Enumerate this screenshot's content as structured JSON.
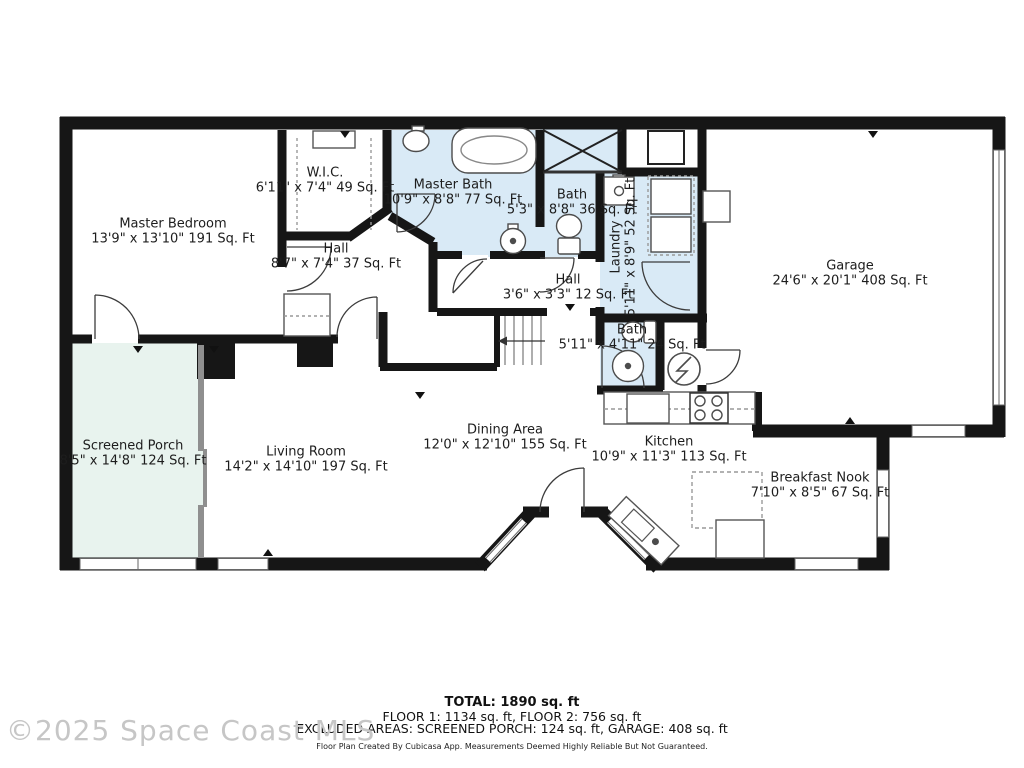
{
  "watermark": "©2025 Space Coast MLS",
  "rooms": {
    "master_bedroom": {
      "name": "Master Bedroom",
      "dims": "13'9\" x 13'10\" 191 Sq. Ft"
    },
    "wic": {
      "name": "W.I.C.",
      "dims": "6'11\" x 7'4\" 49 Sq. Ft"
    },
    "master_bath": {
      "name": "Master Bath",
      "dims": "10'9\" x 8'8\" 77 Sq. Ft"
    },
    "bath_upper": {
      "name": "Bath",
      "dims": "5'3\" x 8'8\" 36 Sq. Ft"
    },
    "laundry": {
      "name": "Laundry",
      "dims": "5'11\" x 8'9\" 52 Sq. Ft"
    },
    "garage": {
      "name": "Garage",
      "dims": "24'6\" x 20'1\" 408 Sq. Ft"
    },
    "hall": {
      "name": "Hall",
      "dims": "8'7\" x 7'4\" 37 Sq. Ft"
    },
    "hall_small": {
      "name": "Hall",
      "dims": "3'6\" x 3'3\" 12 Sq. Ft"
    },
    "bath_lower": {
      "name": "Bath",
      "dims": "5'11\" x 4'11\" 24 Sq. Ft"
    },
    "screened_porch": {
      "name": "Screened Porch",
      "dims": "8'5\" x 14'8\" 124 Sq. Ft"
    },
    "living_room": {
      "name": "Living Room",
      "dims": "14'2\" x 14'10\" 197 Sq. Ft"
    },
    "dining_area": {
      "name": "Dining Area",
      "dims": "12'0\" x 12'10\" 155 Sq. Ft"
    },
    "kitchen": {
      "name": "Kitchen",
      "dims": "10'9\" x 11'3\" 113 Sq. Ft"
    },
    "breakfast_nook": {
      "name": "Breakfast Nook",
      "dims": "7'10\" x 8'5\" 67 Sq. Ft"
    }
  },
  "footer": {
    "total": "TOTAL: 1890 sq. ft",
    "floors": "FLOOR 1: 1134 sq. ft, FLOOR 2: 756 sq. ft",
    "excluded": "EXCLUDED AREAS: SCREENED PORCH: 124 sq. ft, GARAGE: 408 sq. ft",
    "disclaimer": "Floor Plan Created By Cubicasa App. Measurements Deemed Highly Reliable But Not Guaranteed."
  },
  "colors": {
    "wall": "#161616",
    "bath_fill": "#d9eaf6",
    "porch_fill": "#e8f3ee",
    "watermark": "#c6c6c6"
  }
}
